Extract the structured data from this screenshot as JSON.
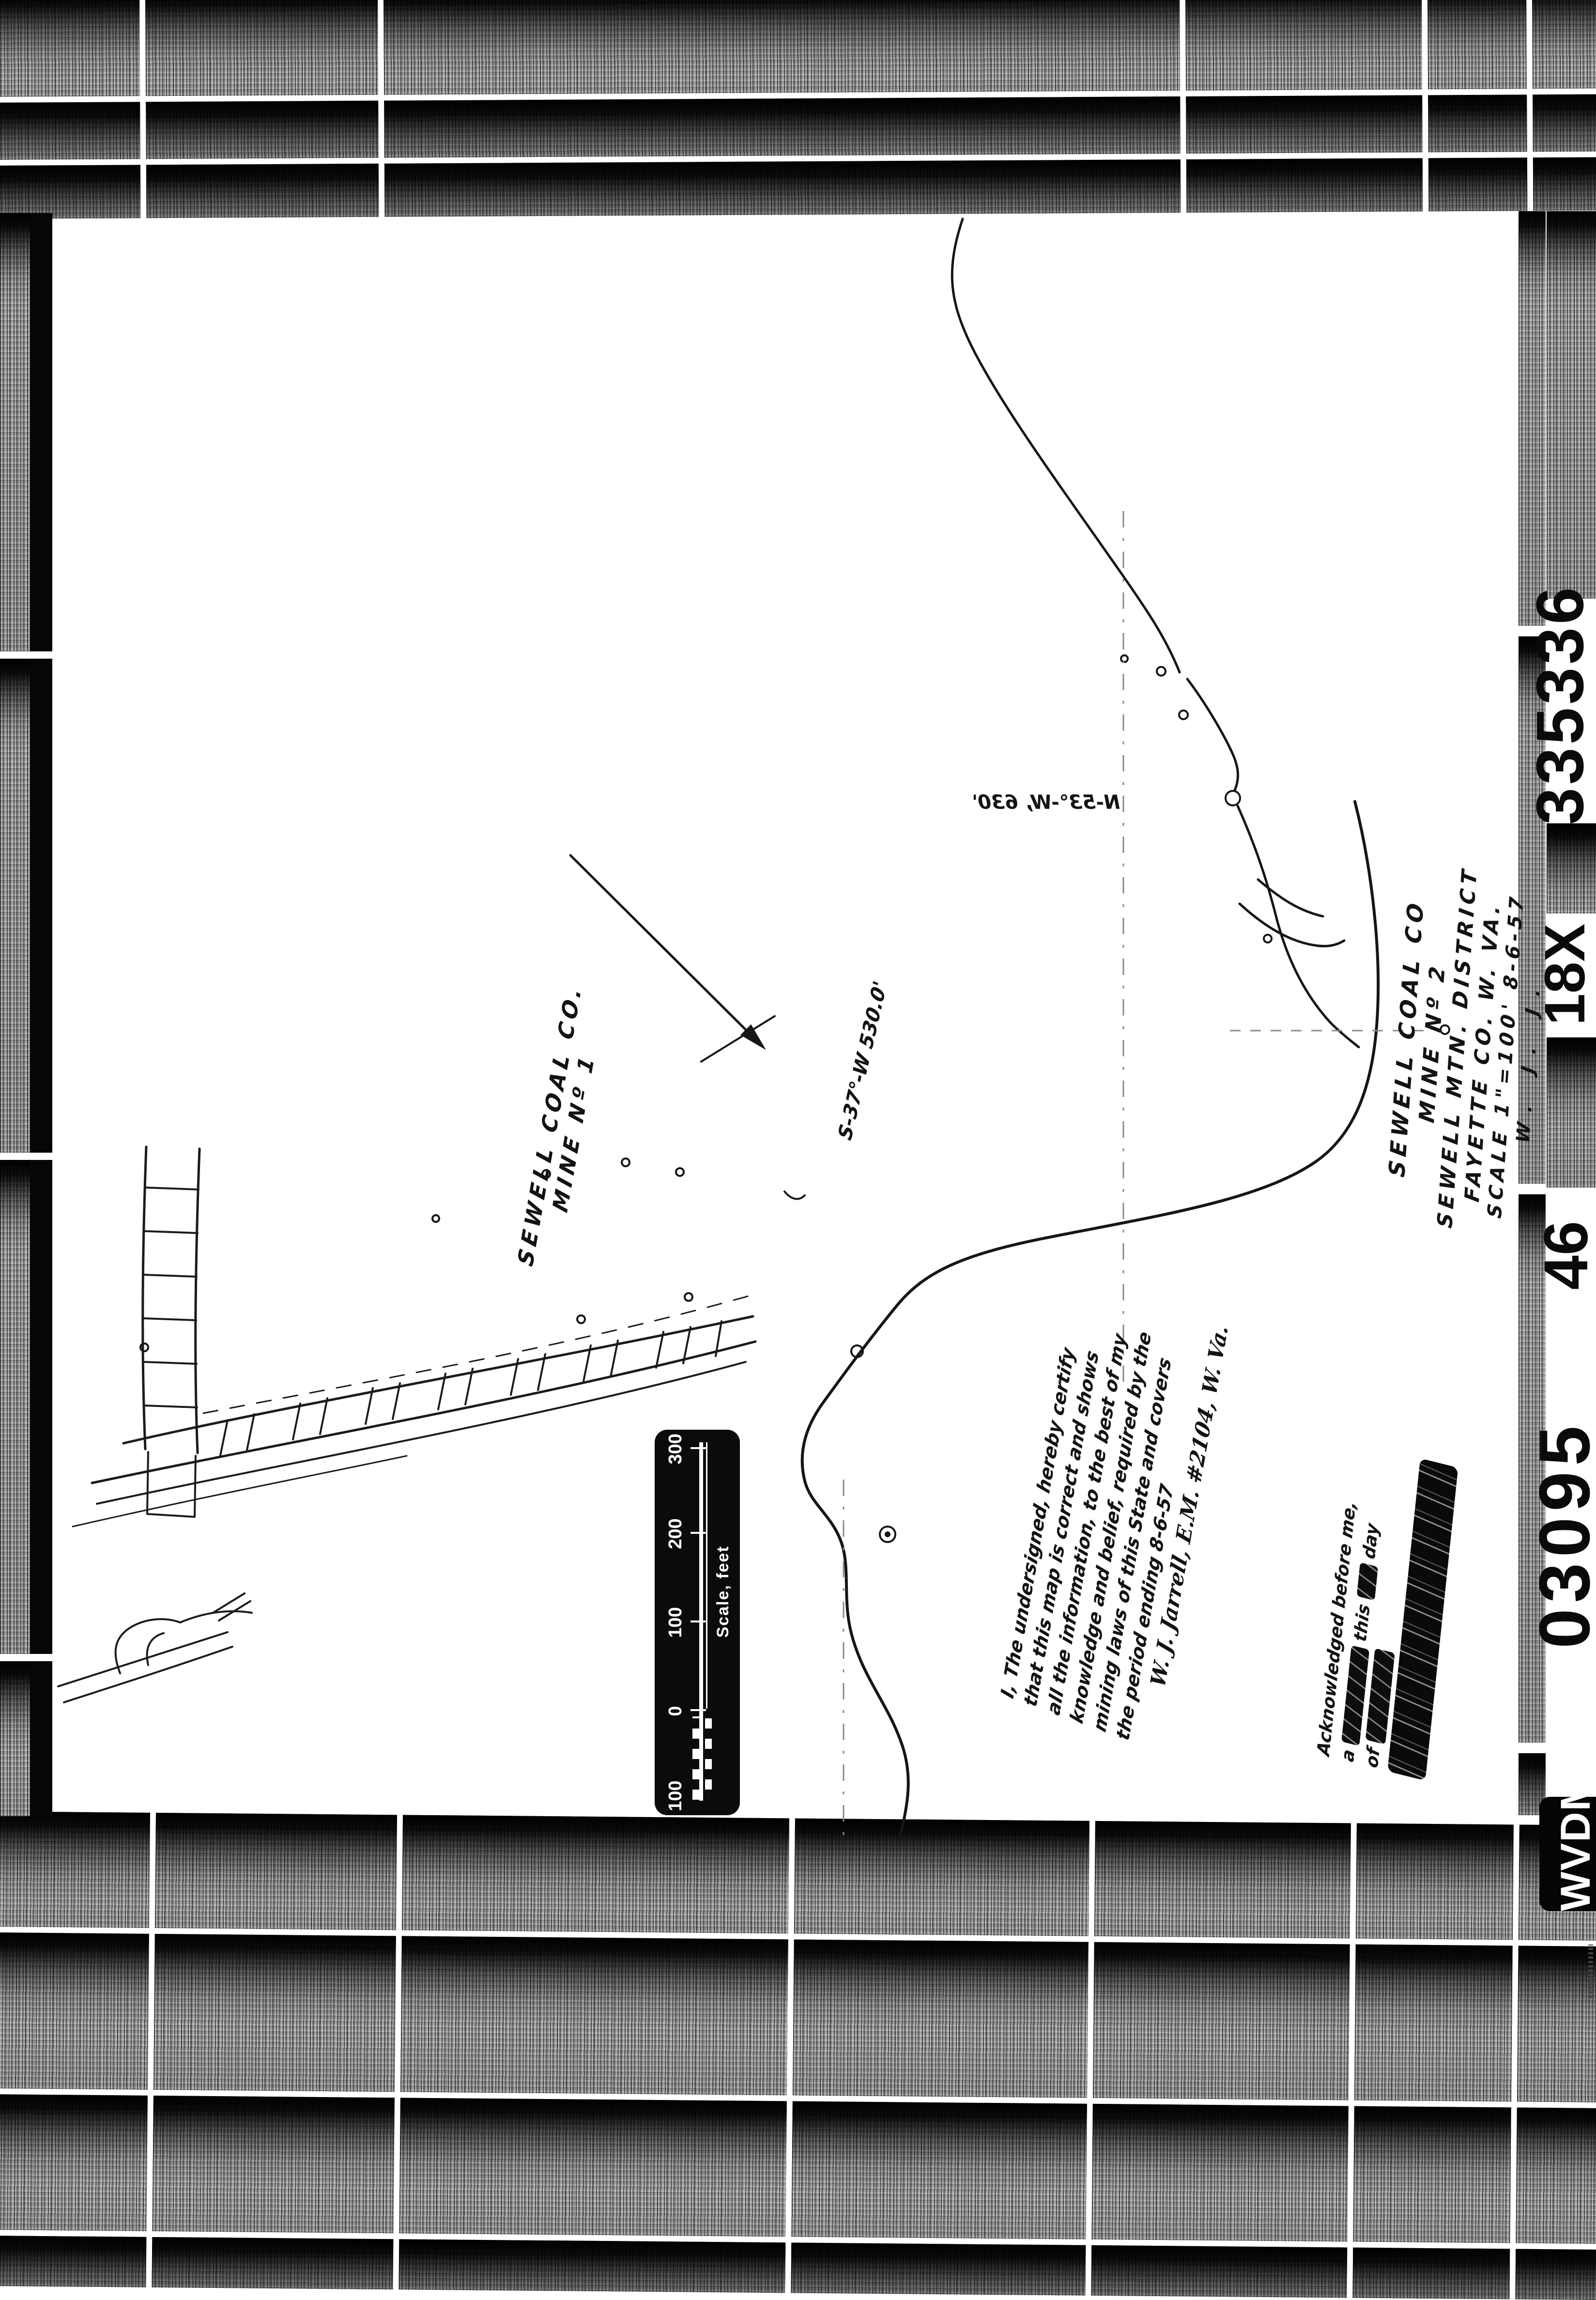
{
  "titles": {
    "mine2": [
      "SEWELL COAL CO",
      "MINE Nº 2",
      "SEWELL MTN. DISTRICT",
      "FAYETTE CO. W. VA.",
      "SCALE 1\"=100'    8-6-57",
      "W. J. J."
    ],
    "mine1": [
      "SEWELL COAL CO.",
      "MINE Nº 1"
    ]
  },
  "bearings": {
    "s37": "S-37°-W    530.0'",
    "n53": "N-53°-W, 630'"
  },
  "certification": {
    "lines": [
      "I, The undersigned, hereby certify",
      "that this map is correct and shows",
      "all the information, to the best of my",
      "knowledge and belief, required by the",
      "mining laws of this State and covers",
      "the period ending  8-6-57",
      "W. J. Jarrell, E.M. #2104, W. Va."
    ]
  },
  "acknowledgment": {
    "line1": "Acknowledged before me,",
    "line2_a": "a",
    "line2_b": "this",
    "line2_c": "day",
    "line3_a": "of"
  },
  "scalebar": {
    "labels": [
      "100",
      "0",
      "100",
      "200",
      "300"
    ],
    "caption": "Scale, feet"
  },
  "film_edge": {
    "numbers": [
      "335336",
      "18X",
      "46",
      "03095"
    ],
    "badge": "WVDM"
  },
  "colors": {
    "ink": "#141414",
    "paper": "#ffffff",
    "film_black": "#000000"
  }
}
